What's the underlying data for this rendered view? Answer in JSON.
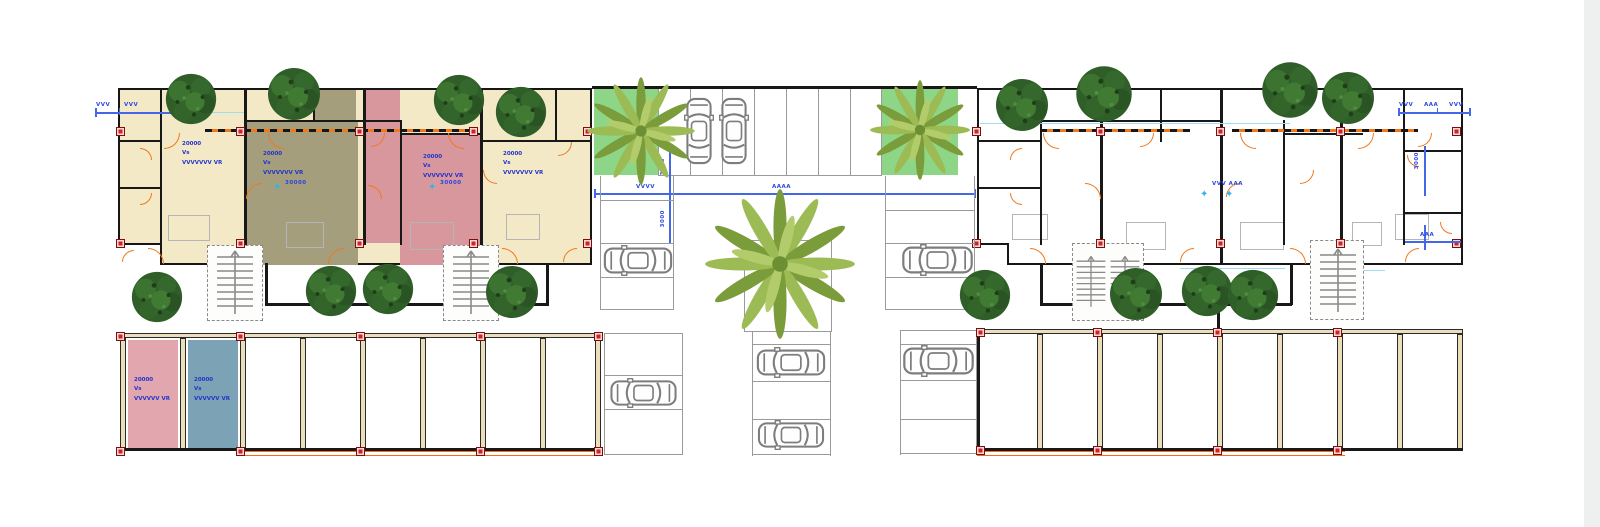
{
  "colors": {
    "background": "#ffffff",
    "right_margin_strip": "#eef0f0",
    "wall_black": "#181818",
    "room_cream": "#f3e9c6",
    "room_olive": "#a49e7c",
    "room_pink": "#d8979d",
    "stall_pink": "#e2a6ae",
    "stall_blue": "#7ba3b5",
    "grass_green": "#8ed687",
    "door_orange": "#f0791c",
    "boundary_orange": "#f56a12",
    "column_red": "#d62020",
    "annotation_blue": "#2233cc",
    "dim_cyan": "#9fdcf2",
    "stall_line_gray": "#9a9a9a",
    "tree_green": "#2f5e28",
    "palm_green": "#8fae44",
    "car_gray": "#7d7d7d"
  },
  "labels": {
    "unit_area": "20000\nVs\nVVVVVVV VR",
    "stall_area": "20000\nVs\nVVVVVV VR",
    "area_small": "30000",
    "dim_3000": "3000",
    "dim_vvv": "VVV",
    "dim_vvvv": "VVVV",
    "dim_aaa": "AAA",
    "dim_aaa_long": "AAAA",
    "dim_vvv_aaa": "VVV AAA",
    "star": "✦"
  },
  "icons": {
    "tree": "round deciduous tree, dark green cluster",
    "palm": "palm tree starburst fronds, yellow-green",
    "car": "top-view sedan, gray outline",
    "column": "red structural column marker",
    "door": "orange quarter-circle door swing",
    "stairs": "gray stair flight with dashed shaft"
  }
}
